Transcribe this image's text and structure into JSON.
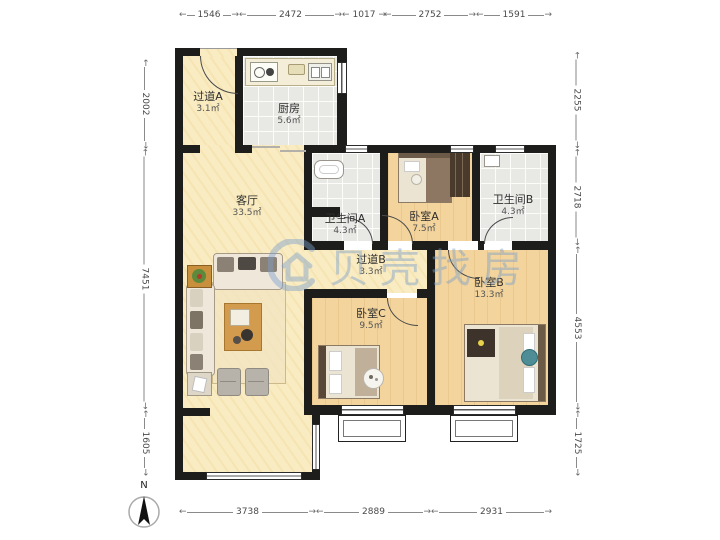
{
  "watermark": {
    "brand": "贝壳找房"
  },
  "compass": {
    "north_label": "N"
  },
  "dimensions": {
    "top": [
      "1546",
      "2472",
      "1017",
      "2752",
      "1591"
    ],
    "bottom": [
      "3738",
      "2889",
      "2931"
    ],
    "left": [
      "2002",
      "7451",
      "1605"
    ],
    "right": [
      "2255",
      "2718",
      "4553",
      "1725"
    ]
  },
  "rooms": {
    "hallway_a": {
      "name": "过道A",
      "area": "3.1㎡"
    },
    "kitchen": {
      "name": "厨房",
      "area": "5.6㎡"
    },
    "living": {
      "name": "客厅",
      "area": "33.5㎡"
    },
    "bath_a": {
      "name": "卫生间A",
      "area": "4.3㎡"
    },
    "bed_a": {
      "name": "卧室A",
      "area": "7.5㎡"
    },
    "bath_b": {
      "name": "卫生间B",
      "area": "4.3㎡"
    },
    "hallway_b": {
      "name": "过道B",
      "area": "3.3㎡"
    },
    "bed_c": {
      "name": "卧室C",
      "area": "9.5㎡"
    },
    "bed_b": {
      "name": "卧室B",
      "area": "13.3㎡"
    }
  },
  "colors": {
    "wall": "#1d1d1b",
    "floor_living": "#f9ecc2",
    "floor_wood": "#f3d49c",
    "floor_tile": "#e8e9e5",
    "watermark_blue": "#7da0cd",
    "dimension_text": "#4a4a4a"
  }
}
